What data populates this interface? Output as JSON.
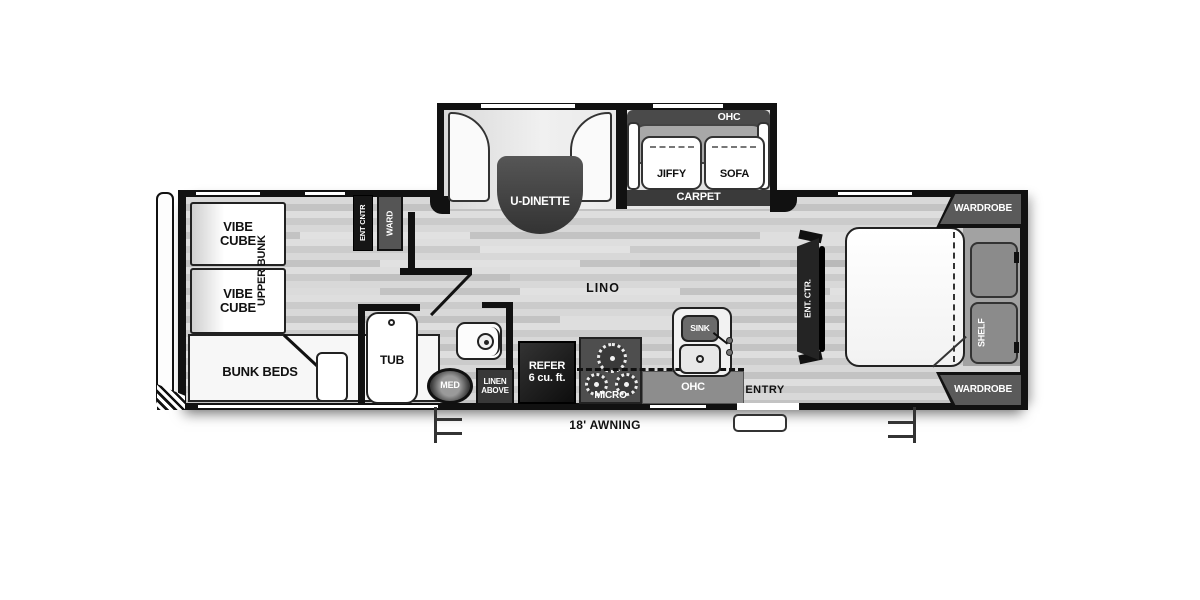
{
  "floorplan": {
    "type": "travel-trailer-floorplan",
    "labels": {
      "vibe_cube_top": "VIBE\nCUBE",
      "vibe_cube_bottom": "VIBE\nCUBE",
      "upper_bunk": "UPPER BUNK",
      "bunk_beds": "BUNK BEDS",
      "ent_cntr": "ENT CNTR",
      "ward": "WARD",
      "tub": "TUB",
      "med": "MED",
      "linen_above": "LINEN\nABOVE",
      "refer": "REFER\n6 cu. ft.",
      "micro": "MICRO",
      "ohc_kitchen": "OHC",
      "sink": "SINK",
      "entry": "ENTRY",
      "lino": "LINO",
      "u_dinette": "U-DINETTE",
      "ohc_sofa": "OHC",
      "jiffy": "JIFFY",
      "sofa": "SOFA",
      "carpet": "CARPET",
      "ent_ctr": "ENT. CTR.",
      "wardrobe_top": "WARDROBE",
      "wardrobe_bottom": "WARDROBE",
      "shelf": "SHELF",
      "awning": "18' AWNING"
    },
    "colors": {
      "wall": "#111111",
      "cabinet_dark": "#242424",
      "cabinet_gray": "#5a5a5a",
      "ohc_strip": "#8d8d8d",
      "carpet": "#3a3a3a",
      "floor_light": "#d6d6d6",
      "furniture": "#ffffff"
    }
  }
}
